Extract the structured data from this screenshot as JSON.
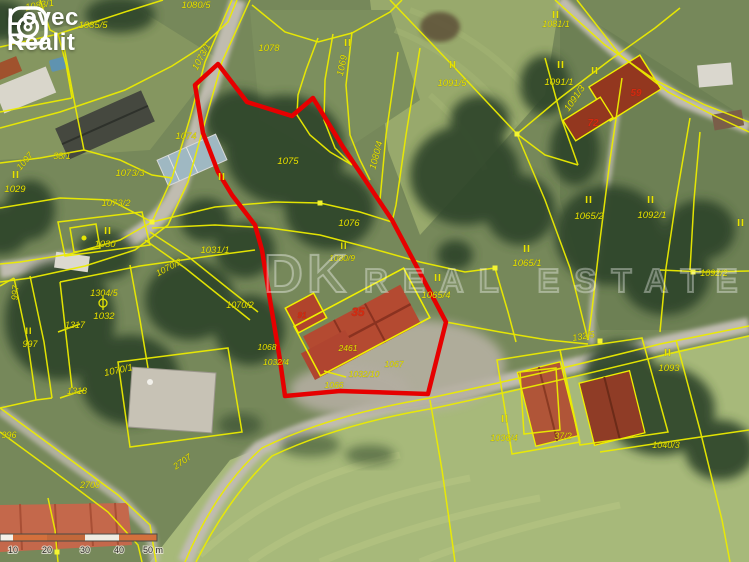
{
  "brand": {
    "line1": "Lovec",
    "line2": "Realit"
  },
  "watermark": {
    "primary": "DK",
    "secondary": "REAL ESTATE"
  },
  "scalebar": {
    "labels": [
      {
        "t": "10",
        "x": 13
      },
      {
        "t": "20",
        "x": 47
      },
      {
        "t": "30",
        "x": 85
      },
      {
        "t": "40",
        "x": 119
      },
      {
        "t": "50 m",
        "x": 153
      }
    ]
  },
  "colors": {
    "cadastral_line_yellow": "#ecec00",
    "label_yellow": "#e8e300",
    "house_number_red": "#d42a10",
    "highlight_outline_red": "#e60000",
    "scalebar_orange": "#d4703c"
  },
  "map_labels": [
    {
      "t": "1083/1",
      "x": 40,
      "y": 8,
      "r": -10,
      "k": "p"
    },
    {
      "t": "1085/5",
      "x": 93,
      "y": 28,
      "r": 0,
      "k": "p"
    },
    {
      "t": "1080/5",
      "x": 196,
      "y": 8,
      "r": 0,
      "k": "p"
    },
    {
      "t": "1073/1",
      "x": 204,
      "y": 58,
      "r": -62,
      "k": "p"
    },
    {
      "t": "1078",
      "x": 269,
      "y": 51,
      "r": 0,
      "k": "p"
    },
    {
      "t": "II",
      "x": 348,
      "y": 46,
      "r": 0,
      "k": "r"
    },
    {
      "t": "1069",
      "x": 345,
      "y": 66,
      "r": -78,
      "k": "p"
    },
    {
      "t": "1080/4",
      "x": 379,
      "y": 156,
      "r": -75,
      "k": "p"
    },
    {
      "t": "II",
      "x": 453,
      "y": 68,
      "r": 0,
      "k": "r"
    },
    {
      "t": "1091/5",
      "x": 452,
      "y": 86,
      "r": 0,
      "k": "p"
    },
    {
      "t": "II",
      "x": 561,
      "y": 68,
      "r": 0,
      "k": "r"
    },
    {
      "t": "1091/1",
      "x": 559,
      "y": 85,
      "r": 0,
      "k": "p"
    },
    {
      "t": "II",
      "x": 556,
      "y": 18,
      "r": 0,
      "k": "r"
    },
    {
      "t": "1081/1",
      "x": 556,
      "y": 27,
      "r": 0,
      "k": "p",
      "s": 9
    },
    {
      "t": "1091/3",
      "x": 577,
      "y": 100,
      "r": -55,
      "k": "p"
    },
    {
      "t": "59",
      "x": 636,
      "y": 96,
      "r": 0,
      "k": "h"
    },
    {
      "t": "72",
      "x": 593,
      "y": 126,
      "r": 0,
      "k": "h"
    },
    {
      "t": "II",
      "x": 595,
      "y": 74,
      "r": 0,
      "k": "r"
    },
    {
      "t": "1074",
      "x": 186,
      "y": 139,
      "r": 0,
      "k": "p"
    },
    {
      "t": "1075",
      "x": 288,
      "y": 164,
      "r": 0,
      "k": "p"
    },
    {
      "t": "1073/3",
      "x": 130,
      "y": 176,
      "r": 0,
      "k": "p"
    },
    {
      "t": "1073/2",
      "x": 116,
      "y": 206,
      "r": 0,
      "k": "p"
    },
    {
      "t": "II",
      "x": 16,
      "y": 178,
      "r": 0,
      "k": "r"
    },
    {
      "t": "1029",
      "x": 15,
      "y": 192,
      "r": 0,
      "k": "p"
    },
    {
      "t": "38/1",
      "x": 62,
      "y": 159,
      "r": 0,
      "k": "p",
      "s": 9
    },
    {
      "t": "1097",
      "x": 27,
      "y": 163,
      "r": -50,
      "k": "p",
      "s": 9
    },
    {
      "t": "II",
      "x": 108,
      "y": 234,
      "r": 0,
      "k": "r"
    },
    {
      "t": "1030",
      "x": 105,
      "y": 247,
      "r": 0,
      "k": "p"
    },
    {
      "t": "II",
      "x": 222,
      "y": 180,
      "r": 0,
      "k": "r"
    },
    {
      "t": "1031/1",
      "x": 215,
      "y": 253,
      "r": 0,
      "k": "p"
    },
    {
      "t": "1076",
      "x": 349,
      "y": 226,
      "r": 0,
      "k": "p"
    },
    {
      "t": "II",
      "x": 344,
      "y": 249,
      "r": 0,
      "k": "r",
      "s": 9
    },
    {
      "t": "1080/9",
      "x": 342,
      "y": 261,
      "r": 0,
      "k": "p",
      "s": 8.5
    },
    {
      "t": "II",
      "x": 438,
      "y": 281,
      "r": 0,
      "k": "r"
    },
    {
      "t": "1065/4",
      "x": 436,
      "y": 298,
      "r": 0,
      "k": "p"
    },
    {
      "t": "II",
      "x": 589,
      "y": 203,
      "r": 0,
      "k": "r"
    },
    {
      "t": "1065/2",
      "x": 589,
      "y": 219,
      "r": 0,
      "k": "p"
    },
    {
      "t": "II",
      "x": 651,
      "y": 203,
      "r": 0,
      "k": "r"
    },
    {
      "t": "1092/1",
      "x": 652,
      "y": 218,
      "r": 0,
      "k": "p"
    },
    {
      "t": "II",
      "x": 527,
      "y": 252,
      "r": 0,
      "k": "r"
    },
    {
      "t": "1065/1",
      "x": 527,
      "y": 266,
      "r": 0,
      "k": "p"
    },
    {
      "t": "1092/2",
      "x": 714,
      "y": 276,
      "r": 0,
      "k": "p",
      "s": 9
    },
    {
      "t": "II",
      "x": 741,
      "y": 226,
      "r": 0,
      "k": "r"
    },
    {
      "t": "1070/2",
      "x": 170,
      "y": 270,
      "r": -28,
      "k": "p",
      "s": 9
    },
    {
      "t": "1070/2",
      "x": 240,
      "y": 308,
      "r": 0,
      "k": "p",
      "s": 9
    },
    {
      "t": "1068",
      "x": 267,
      "y": 350,
      "r": 0,
      "k": "p",
      "s": 8.5
    },
    {
      "t": "1032/4",
      "x": 276,
      "y": 365,
      "r": 0,
      "k": "p",
      "s": 8.5
    },
    {
      "t": "91",
      "x": 302,
      "y": 318,
      "r": 0,
      "k": "h",
      "s": 8
    },
    {
      "t": "35",
      "x": 358,
      "y": 316,
      "r": 0,
      "k": "h",
      "s": 12
    },
    {
      "t": "2461",
      "x": 348,
      "y": 351,
      "r": 0,
      "k": "p",
      "s": 8.5
    },
    {
      "t": "1067",
      "x": 394,
      "y": 367,
      "r": 0,
      "k": "p",
      "s": 8.5
    },
    {
      "t": "1032/10",
      "x": 364,
      "y": 377,
      "r": 0,
      "k": "p",
      "s": 8.5
    },
    {
      "t": "1066",
      "x": 334,
      "y": 388,
      "r": 0,
      "k": "p",
      "s": 8.5
    },
    {
      "t": "1304/5",
      "x": 104,
      "y": 296,
      "r": 0,
      "k": "p",
      "s": 9
    },
    {
      "t": "1032",
      "x": 104,
      "y": 319,
      "r": 0,
      "k": "p"
    },
    {
      "t": "1317",
      "x": 75,
      "y": 328,
      "r": 0,
      "k": "p",
      "s": 9
    },
    {
      "t": "1318",
      "x": 77,
      "y": 394,
      "r": 0,
      "k": "p",
      "s": 9
    },
    {
      "t": "II",
      "x": 29,
      "y": 334,
      "r": 0,
      "k": "r",
      "s": 9
    },
    {
      "t": "997",
      "x": 30,
      "y": 347,
      "r": 0,
      "k": "p",
      "s": 9
    },
    {
      "t": "997",
      "x": 18,
      "y": 293,
      "r": -85,
      "k": "p",
      "s": 9
    },
    {
      "t": "996",
      "x": 9,
      "y": 438,
      "r": 0,
      "k": "p",
      "s": 9
    },
    {
      "t": "2708",
      "x": 90,
      "y": 488,
      "r": 0,
      "k": "p",
      "s": 9
    },
    {
      "t": "2707",
      "x": 184,
      "y": 464,
      "r": -35,
      "k": "p",
      "s": 9
    },
    {
      "t": "1070/1",
      "x": 119,
      "y": 373,
      "r": -12,
      "k": "p"
    },
    {
      "t": "132/5",
      "x": 584,
      "y": 339,
      "r": -10,
      "k": "p",
      "s": 9
    },
    {
      "t": "II",
      "x": 668,
      "y": 356,
      "r": 0,
      "k": "r"
    },
    {
      "t": "1093",
      "x": 669,
      "y": 371,
      "r": 0,
      "k": "p"
    },
    {
      "t": "II",
      "x": 505,
      "y": 422,
      "r": 0,
      "k": "r"
    },
    {
      "t": "1036/4",
      "x": 504,
      "y": 441,
      "r": 0,
      "k": "p",
      "s": 9
    },
    {
      "t": "37/2",
      "x": 563,
      "y": 439,
      "r": 0,
      "k": "p",
      "s": 9
    },
    {
      "t": "1040/3",
      "x": 666,
      "y": 448,
      "r": 0,
      "k": "p",
      "s": 9
    }
  ]
}
